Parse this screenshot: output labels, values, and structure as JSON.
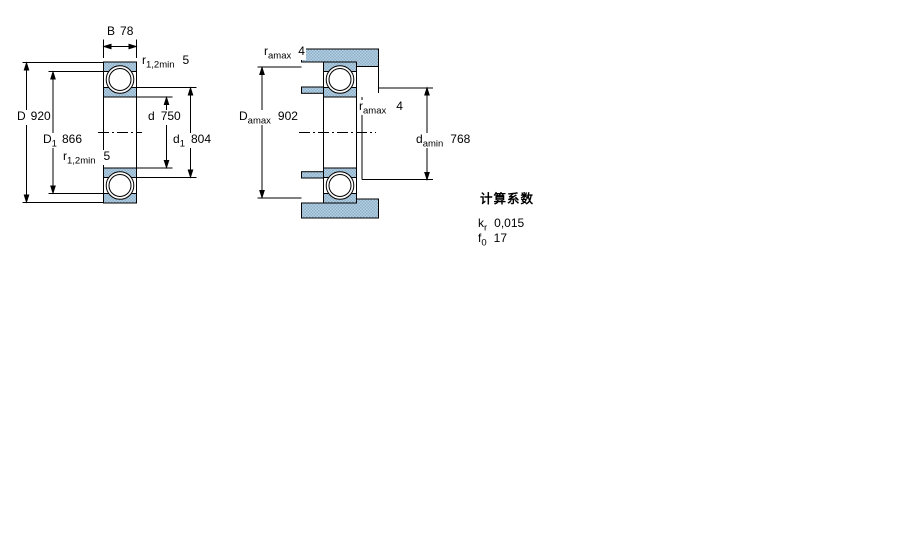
{
  "page": {
    "background": "#ffffff"
  },
  "colors": {
    "hatch_light": "#b7cfe2",
    "hatch_dark": "#8db1ca",
    "line": "#000000"
  },
  "left_drawing": {
    "name": "bearing-cross-section-dimensions",
    "dims": {
      "B": {
        "symbol": "B",
        "sub": "",
        "value": "78"
      },
      "r_top": {
        "symbol": "r",
        "sub": "1,2min",
        "value": "5"
      },
      "D": {
        "symbol": "D",
        "sub": "",
        "value": "920"
      },
      "D1": {
        "symbol": "D",
        "sub": "1",
        "value": "866"
      },
      "r_bottom": {
        "symbol": "r",
        "sub": "1,2min",
        "value": "5"
      },
      "d": {
        "symbol": "d",
        "sub": "",
        "value": "750"
      },
      "d1": {
        "symbol": "d",
        "sub": "1",
        "value": "804"
      }
    }
  },
  "right_drawing": {
    "name": "bearing-abutment-dimensions",
    "dims": {
      "ra_top": {
        "symbol": "r",
        "sub": "amax",
        "value": "4"
      },
      "Da_max": {
        "symbol": "D",
        "sub": "amax",
        "value": "902"
      },
      "ra_mid": {
        "symbol": "r",
        "sub": "amax",
        "value": "4"
      },
      "da_min": {
        "symbol": "d",
        "sub": "amin",
        "value": "768"
      }
    }
  },
  "calc_factors": {
    "title": "计算系数",
    "rows": [
      {
        "symbol": "k",
        "sub": "r",
        "value": "0,015"
      },
      {
        "symbol": "f",
        "sub": "0",
        "value": "17"
      }
    ]
  }
}
